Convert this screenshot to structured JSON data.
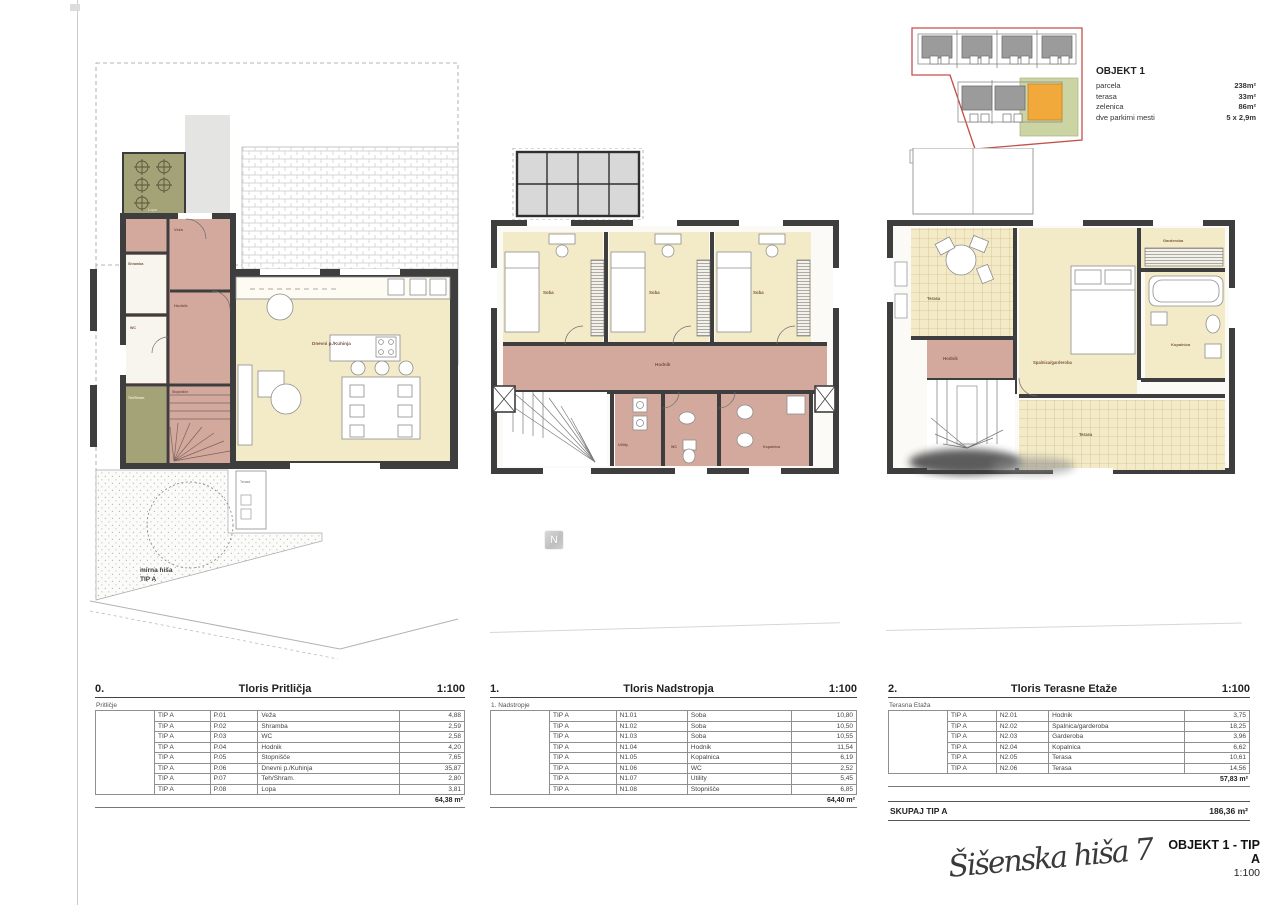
{
  "site_key": {
    "title": "OBJEKT 1",
    "rows": [
      {
        "label": "parcela",
        "value": "238m²"
      },
      {
        "label": "terasa",
        "value": "33m²"
      },
      {
        "label": "zelenica",
        "value": "86m²"
      },
      {
        "label": "dve parkirni mesti",
        "value": "5 x 2,9m"
      }
    ]
  },
  "north_label": "N",
  "plans": {
    "ground": {
      "lopa": "Lopa",
      "veza": "Veža",
      "shramba": "Shramba",
      "wc": "WC",
      "hodnik": "Hodnik",
      "stopnisce": "Stopnišče",
      "dnevni": "Dnevni p./Kuhinja",
      "teh": "Teh/Shram.",
      "terasa": "Terasa",
      "garden_note_1": "mirna hiša",
      "garden_note_2": "TIP A"
    },
    "first": {
      "soba1": "Soba",
      "soba2": "Soba",
      "soba3": "Soba",
      "hodnik": "Hodnik",
      "utility": "Utility",
      "wc": "WC",
      "kopalnica": "Kopalnica"
    },
    "terrace": {
      "terasa_top": "Terasa",
      "hodnik": "Hodnik",
      "spalnica": "Spalnica/garderoba",
      "garderoba": "Garderoba",
      "kopalnica": "Kopalnica",
      "terasa_bottom": "Terasa"
    }
  },
  "tables": [
    {
      "index": "0.",
      "title": "Tloris Pritličja",
      "scale": "1:100",
      "subtitle": "Pritličje",
      "rows": [
        [
          "TIP A",
          "P.01",
          "Veža",
          "4,88"
        ],
        [
          "TIP A",
          "P.02",
          "Shramba",
          "2,59"
        ],
        [
          "TIP A",
          "P.03",
          "WC",
          "2,58"
        ],
        [
          "TIP A",
          "P.04",
          "Hodnik",
          "4,20"
        ],
        [
          "TIP A",
          "P.05",
          "Stopnišče",
          "7,65"
        ],
        [
          "TIP A",
          "P.06",
          "Dnevni p./Kuhinja",
          "35,87"
        ],
        [
          "TIP A",
          "P.07",
          "Teh/Shram.",
          "2,80"
        ],
        [
          "TIP A",
          "P.08",
          "Lopa",
          "3,81"
        ]
      ],
      "total": "64,38 m²"
    },
    {
      "index": "1.",
      "title": "Tloris Nadstropja",
      "scale": "1:100",
      "subtitle": "1. Nadstropje",
      "rows": [
        [
          "TIP A",
          "N1.01",
          "Soba",
          "10,80"
        ],
        [
          "TIP A",
          "N1.02",
          "Soba",
          "10,50"
        ],
        [
          "TIP A",
          "N1.03",
          "Soba",
          "10,55"
        ],
        [
          "TIP A",
          "N1.04",
          "Hodnik",
          "11,54"
        ],
        [
          "TIP A",
          "N1.05",
          "Kopalnica",
          "6,19"
        ],
        [
          "TIP A",
          "N1.06",
          "WC",
          "2,52"
        ],
        [
          "TIP A",
          "N1.07",
          "Utility",
          "5,45"
        ],
        [
          "TIP A",
          "N1.08",
          "Stopnišče",
          "6,85"
        ]
      ],
      "total": "64,40 m²"
    },
    {
      "index": "2.",
      "title": "Tloris Terasne Etaže",
      "scale": "1:100",
      "subtitle": "Terasna Etaža",
      "rows": [
        [
          "TIP A",
          "N2.01",
          "Hodnik",
          "3,75"
        ],
        [
          "TIP A",
          "N2.02",
          "Spalnica/garderoba",
          "18,25"
        ],
        [
          "TIP A",
          "N2.03",
          "Garderoba",
          "3,96"
        ],
        [
          "TIP A",
          "N2.04",
          "Kopalnica",
          "6,62"
        ],
        [
          "TIP A",
          "N2.05",
          "Terasa",
          "10,61"
        ],
        [
          "TIP A",
          "N2.06",
          "Terasa",
          "14,56"
        ]
      ],
      "total": "57,83 m²"
    }
  ],
  "summary": {
    "label": "SKUPAJ TIP A",
    "value": "186,36 m²"
  },
  "titleblock": {
    "signature": "Šišenska hiša 7",
    "project": "OBJEKT 1 - TIP A",
    "scale": "1:100"
  },
  "colors": {
    "room_cream": "#f3ebc8",
    "corridor_pink": "#d3a99e",
    "shed_olive": "#a4a378",
    "wall_dark": "#3e3e3e",
    "highlight_orange": "#f2a93b",
    "parcel_red": "#c4504a",
    "green_patch": "#cdd4a4"
  }
}
